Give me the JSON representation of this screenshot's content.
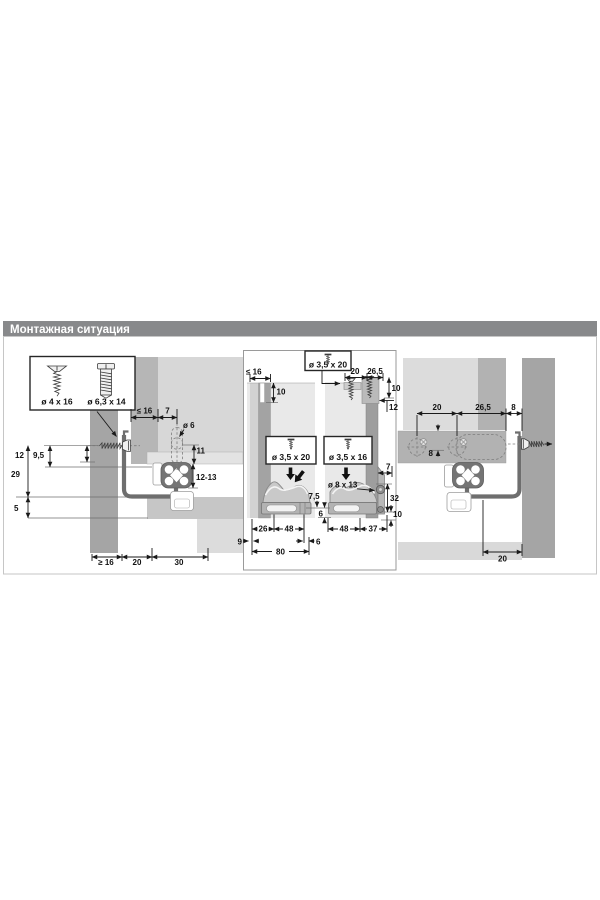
{
  "header": {
    "title": "Монтажная ситуация"
  },
  "legend": {
    "screw_countersunk": "ø 4 x 16",
    "screw_euro": "ø 6,3 x 14"
  },
  "left_view": {
    "top": {
      "panel_thickness_max": "≤ 16",
      "hole_offset": "7",
      "hole_dia": "ø 6",
      "hole_depth": "11",
      "height_adjust": "12-13"
    },
    "left": {
      "screw_to_top": "12",
      "screw_edge": "9,5",
      "d29": "29",
      "d5": "5"
    },
    "bottom": {
      "side_min": "≥ 16",
      "d20": "20",
      "d30": "30"
    }
  },
  "rear_view": {
    "top_box": {
      "screw": "ø 3,5 x 20"
    },
    "top_dims": {
      "d20": "20",
      "d265": "26,5",
      "d10": "10",
      "d12": "12"
    },
    "left_section": {
      "panel_thickness_max": "≤ 16",
      "slot_depth": "10",
      "screw": "ø 3,5 x 20",
      "d75": "7,5",
      "d6_height": "6",
      "d26": "26",
      "d48": "48",
      "d9": "9",
      "d6": "6",
      "d80": "80"
    },
    "right_section": {
      "screw": "ø 3,5 x 16",
      "hole": "ø 8 x 13",
      "d7": "7",
      "d32": "32",
      "d10": "10",
      "d48": "48",
      "d37": "37"
    }
  },
  "right_view": {
    "top": {
      "d20": "20",
      "d265": "26,5",
      "d8": "8"
    },
    "inner": {
      "d8": "8"
    },
    "bottom": {
      "d20": "20"
    }
  },
  "colors": {
    "header_bar": "#88898b",
    "panel_dark": "#a5a5a5",
    "panel_medium": "#b2b2b2",
    "panel_light": "#dcdcdc",
    "profile": "#6e6e6e",
    "dim_line": "#1a1a1a"
  }
}
